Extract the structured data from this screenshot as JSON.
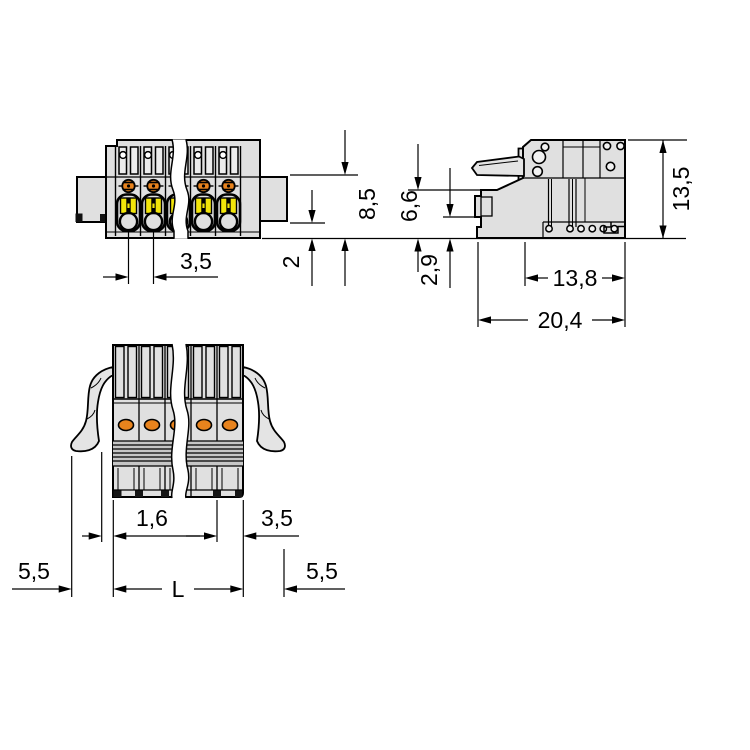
{
  "drawing": {
    "background": "#ffffff",
    "line_color": "#000000",
    "housing_color": "#e0e0e0",
    "accent_orange": "#e8831d",
    "accent_yellow": "#f2e50a",
    "views": {
      "front": {
        "name": "front-view-female-connector",
        "dims": {
          "pitch": "3,5",
          "height": "8,5",
          "rail_offset": "2"
        }
      },
      "side": {
        "name": "side-view-female-connector",
        "dims": {
          "plug_height": "6,6",
          "latch_height": "2,9",
          "total_height": "13,5",
          "housing_depth": "13,8",
          "overall_depth": "20,4"
        }
      },
      "bottom": {
        "name": "bottom-view-with-locking-levers",
        "dims": {
          "lever_offset": "1,6",
          "end_pitch": "3,5",
          "lever_ext_left": "5,5",
          "length": "L",
          "lever_ext_right": "5,5"
        }
      }
    }
  }
}
